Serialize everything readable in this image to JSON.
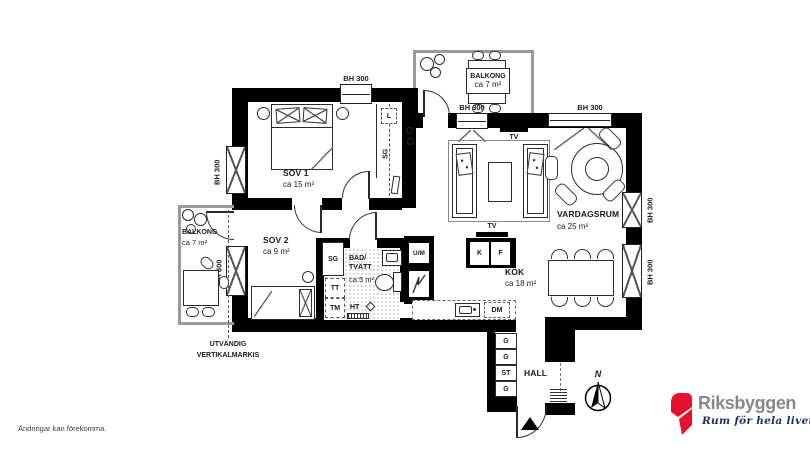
{
  "meta": {
    "disclaimer": "Ändringar kan förekomma."
  },
  "brand": {
    "name": "Riksbyggen",
    "tagline": "Rum för hela livet"
  },
  "colors": {
    "brand_red": "#e8112d",
    "brand_gray": "#87888a",
    "brand_navy": "#1d3054",
    "wall": "#000000"
  },
  "compass": {
    "north": "N"
  },
  "rooms": {
    "sov1": {
      "name": "SOV 1",
      "area": "ca 15 m²"
    },
    "sov2": {
      "name": "SOV 2",
      "area": "ca 9 m²"
    },
    "bad": {
      "line1": "BAD/",
      "line2": "TVÄTT",
      "area": "ca 5 m²"
    },
    "kok": {
      "name": "KÖK",
      "area": "ca 18 m²"
    },
    "vardagsrum": {
      "name": "VARDAGSRUM",
      "area": "ca 25 m²"
    },
    "hall": {
      "name": "HALL"
    },
    "balkong_top": {
      "name": "BALKONG",
      "area": "ca 7 m²"
    },
    "balkong_left": {
      "name": "BALKONG",
      "area": "ca 7 m²"
    }
  },
  "fixtures": {
    "tv": "TV",
    "sg": "SG",
    "l": "L",
    "um": "U/M",
    "tt": "TT",
    "tm": "TM",
    "ht": "HT",
    "dm": "DM",
    "k": "K",
    "f": "F",
    "g": "G",
    "st": "ST"
  },
  "window_labels": {
    "bh300": "BH 300",
    "bh800": "BH 800"
  },
  "annotations": {
    "markis_line1": "UTVÄNDIG",
    "markis_line2": "VERTIKALMARKIS"
  }
}
